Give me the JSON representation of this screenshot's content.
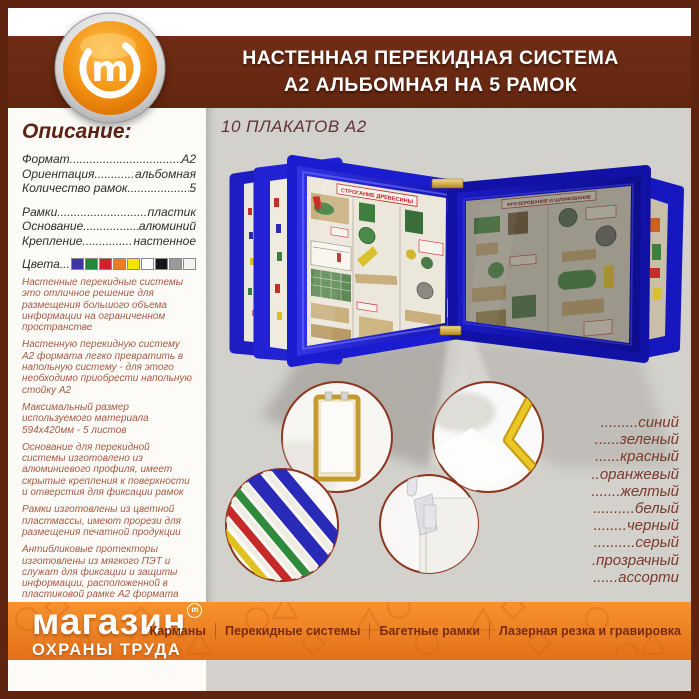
{
  "header": {
    "line1": "НАСТЕННАЯ ПЕРЕКИДНАЯ СИСТЕМА",
    "line2": "А2 АЛЬБОМНАЯ НА 5 РАМОК"
  },
  "logo": {
    "letter": "m"
  },
  "sidebar": {
    "title": "Описание:",
    "specs": [
      {
        "label": "Формат",
        "value": "А2"
      },
      {
        "label": "Ориентация",
        "value": "альбомная"
      },
      {
        "label": "Количество рамок",
        "value": "5"
      },
      {
        "label": "Рамки",
        "value": "пластик"
      },
      {
        "label": "Основание",
        "value": "алюминий"
      },
      {
        "label": "Крепление",
        "value": "настенное"
      }
    ],
    "colors_label": "Цвета",
    "color_swatches": [
      "#3b34a4",
      "#1f8b3a",
      "#d42127",
      "#ee7c1e",
      "#f6e300",
      "#ffffff",
      "#161616",
      "#9b9b9b",
      "#f3f3f1"
    ],
    "paragraphs": [
      "Настенные перекидные системы это отличное решение для размещения большого объема информации на ограниченном пространстве",
      "Настенную перекидную систему А2 формата легко превратить в напольную систему - для этого необходимо приобрести напольную стойку А2",
      "Максимальный размер используемого материала 594х420мм - 5 листов",
      "Основание для перекидной системы изготовлено из алюминиевого профиля, имеет скрытые крепления к поверхности и отверстия для фиксации рамок",
      "Рамки изготовлены из цветной пластмассы, имеют прорези для размещения печатной продукции",
      "Антибликовые протекторы изготовлены из мягкого ПЭТ и служат для фиксации и защиты информации, расположенной в пластиковой рамке А2 формата",
      "Держатели рамки для перекидной системы изготовлены из прозрачного пластика",
      "Изготавливаем настенные, настольные и напольные перекидные системы А4, А3 и А2 формата на любое количество рамок"
    ]
  },
  "main": {
    "caption": "10 ПЛАКАТОВ А2",
    "posters": {
      "left_title": "СТРОГАНИЕ ДРЕВЕСИНЫ",
      "right_title": "ФРЕЗЕРОВАНИЕ И ШЛИФОВАНИЕ"
    },
    "color_list": [
      ".........синий",
      "......зеленый",
      "......красный",
      "..оранжевый",
      ".......желтый",
      "..........белый",
      "........черный",
      "..........серый",
      ".прозрачный",
      "......ассорти"
    ]
  },
  "footer": {
    "brand_line1": "магазин",
    "brand_tm": "m",
    "brand_line2": "ОХРАНЫ ТРУДА",
    "menu": [
      "Карманы",
      "Перекидные системы",
      "Багетные рамки",
      "Лазерная резка и гравировка"
    ]
  },
  "palette": {
    "border_maroon": "#5e2410",
    "header_maroon": "#692a13",
    "band_orange": "#ee811f",
    "frame_blue": "#1b1bd0",
    "wall_gray": "#d4d2cd",
    "text_brick": "#a55a41"
  }
}
